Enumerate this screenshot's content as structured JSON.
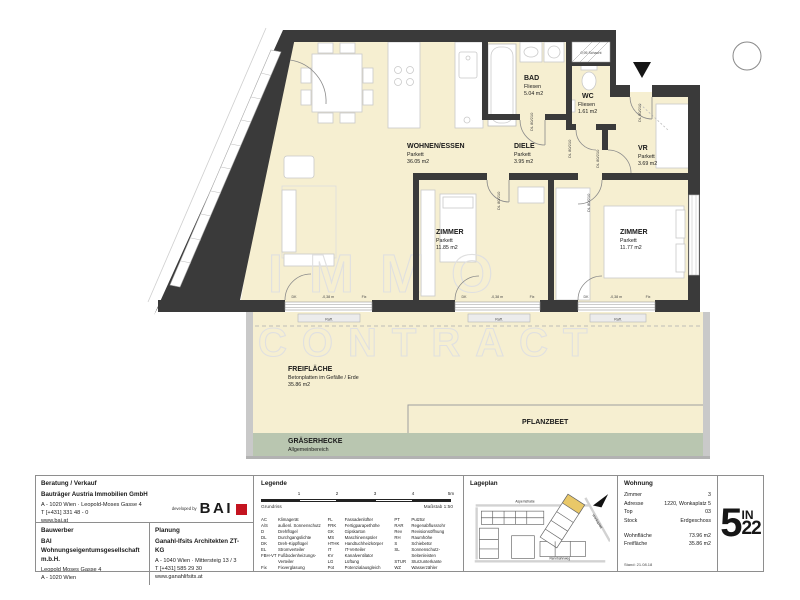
{
  "plan": {
    "watermark": {
      "line1": "IMMO",
      "line2": "CONTRACT"
    },
    "rooms": [
      {
        "name": "WOHNEN/ESSEN",
        "floor": "Parkett",
        "area": "36.05 m2"
      },
      {
        "name": "DIELE",
        "floor": "Parkett",
        "area": "3.95 m2"
      },
      {
        "name": "VR",
        "floor": "Parkett",
        "area": "3.69 m2"
      },
      {
        "name": "BAD",
        "floor": "Fliesen",
        "area": "5.04 m2"
      },
      {
        "name": "WC",
        "floor": "Fliesen",
        "area": "1.61 m2"
      },
      {
        "name": "ZIMMER",
        "floor": "Parkett",
        "area": "11.85 m2"
      },
      {
        "name": "ZIMMER",
        "floor": "Parkett",
        "area": "11.77 m2"
      }
    ],
    "outdoor": {
      "freiflaeche": {
        "name": "FREIFLÄCHE",
        "desc": "Betonplatten im Gefälle / Erde",
        "area": "35.86 m2"
      },
      "pflanzbeet": {
        "name": "PFLANZBEET"
      },
      "graeserhecke": {
        "name": "GRÄSERHECKE",
        "desc": "Allgemeinbereich"
      }
    },
    "doors": {
      "dl80": "DL 80/210",
      "dl90": "DL 90/210"
    },
    "annotations": {
      "dk": "DK",
      "fix": "Fix",
      "level": "-0,38 m",
      "shaft": "0,95 Schacht",
      "blind": "Raff."
    }
  },
  "panel": {
    "consult": {
      "header": "Beratung / Verkauf",
      "company": "Bauträger Austria Immobilien GmbH",
      "address": "A - 1020 Wien · Leopold-Moses Gasse 4",
      "phone": "T [+431] 331 48 - 0",
      "web": "www.bai.at",
      "developed_by": "developed by",
      "logo_text": "BAI"
    },
    "bauwerber": {
      "header": "Bauwerber",
      "company": "BAI Wohnungseigentumsgesellschaft m.b.H.",
      "address1": "Leopold Moses Gasse 4",
      "address2": "A - 1020 Wien"
    },
    "planung": {
      "header": "Planung",
      "company": "Ganahl-Ifsits Architekten ZT-KG",
      "address": "A - 1040 Wien · Mittersteig 13 / 3",
      "phone": "T [+431] 585 29 30",
      "web": "www.ganahlifsits.at"
    },
    "legend": {
      "header": "Legende",
      "scale_ticks": [
        "1",
        "2",
        "3",
        "4",
        "5m"
      ],
      "caption_left": "Grundriss",
      "caption_right": "Maßstab 1:50",
      "entries_col1": [
        [
          "AC",
          "Klimagerät"
        ],
        [
          "A/S",
          "außenl. Sonnenschutz"
        ],
        [
          "D",
          "Drehflügel"
        ],
        [
          "DL",
          "Durchgangslichte"
        ],
        [
          "DK",
          "Dreh-Kippflügel"
        ],
        [
          "EL",
          "Stromverteiler"
        ],
        [
          "FBH-VT",
          "Fußbodenheizungs-Verteiler"
        ],
        [
          "Fix",
          "Fixverglasung"
        ]
      ],
      "entries_col2": [
        [
          "FL",
          "Fassadenlüfter"
        ],
        [
          "FRK",
          "Fertigparapethöhe"
        ],
        [
          "GK",
          "Gipskarton"
        ],
        [
          "MS",
          "Maschinenspüler"
        ],
        [
          "HTHK",
          "Handtuchheizkörper"
        ],
        [
          "IT",
          "IT-Verteiler"
        ],
        [
          "KV",
          "Kanalventilator"
        ],
        [
          "LG",
          "Lüftung"
        ],
        [
          "Pot",
          "Potenzialausgleich"
        ]
      ],
      "entries_col3": [
        [
          "PT",
          "Putztür"
        ],
        [
          "RAR",
          "Regenabflussrohr"
        ],
        [
          "Rev",
          "Revisionsöffnung"
        ],
        [
          "RH",
          "Raumhöhe"
        ],
        [
          "S",
          "Schiebetür"
        ],
        [
          "SL",
          "Sonnenschutz-Seitenleisten"
        ],
        [
          "STUR",
          "Sturzunterkante"
        ],
        [
          "WZ",
          "Wasserzähler"
        ]
      ]
    },
    "lageplan": {
      "header": "Lageplan",
      "street_top": "Aspernstraße",
      "street_right": "Wonkaplatz",
      "street_bottom": "Rennbahnweg"
    },
    "wohnung": {
      "header": "Wohnung",
      "rows": [
        [
          "Zimmer",
          "3"
        ],
        [
          "Adresse",
          "1220, Wonkaplatz 5"
        ],
        [
          "Top",
          "03"
        ],
        [
          "Stock",
          "Erdgeschoss"
        ]
      ],
      "rows2": [
        [
          "Wohnfläche",
          "73.96 m2"
        ],
        [
          "Freifläche",
          "35.86 m2"
        ]
      ],
      "stand": "Stand: 21.08.18"
    },
    "logo": {
      "big": "5",
      "small_top": "IN",
      "small_bottom": "22"
    }
  }
}
